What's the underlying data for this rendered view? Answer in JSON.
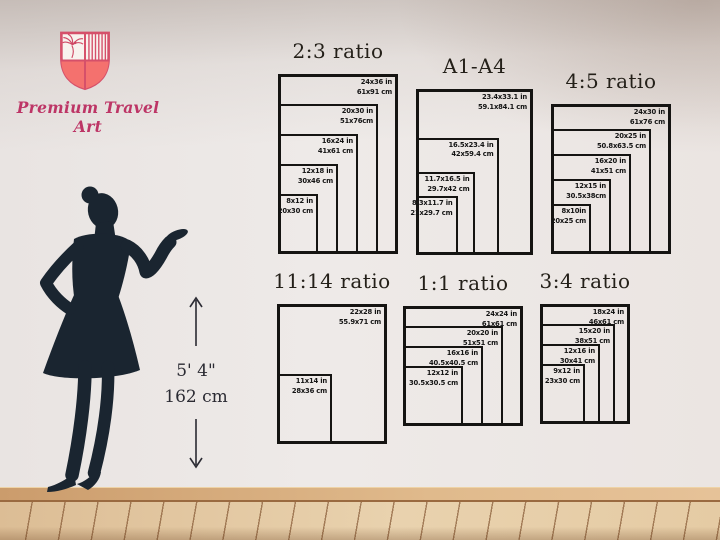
{
  "brand": {
    "name": "Premium Travel Art",
    "logo_icon": "shield-crest-icon",
    "accent_color": "#c9426b",
    "shield_fill_color": "#f4716e"
  },
  "height_marker": {
    "imperial": "5' 4\"",
    "metric": "162 cm"
  },
  "silhouette": {
    "description": "woman-silhouette",
    "color": "#1a2530"
  },
  "chart_data": [
    {
      "type": "nested-rectangles",
      "title": "2:3 ratio",
      "unit_scale_px_per_inch": 5,
      "position": {
        "left": 278,
        "top": 74
      },
      "sizes": [
        {
          "in": "24x36 in",
          "cm": "61x91 cm",
          "w": 24,
          "h": 36
        },
        {
          "in": "20x30 in",
          "cm": "51x76cm",
          "w": 20,
          "h": 30
        },
        {
          "in": "16x24 in",
          "cm": "41x61 cm",
          "w": 16,
          "h": 24
        },
        {
          "in": "12x18 in",
          "cm": "30x46 cm",
          "w": 12,
          "h": 18
        },
        {
          "in": "8x12 in",
          "cm": "20x30 cm",
          "w": 8,
          "h": 12
        }
      ]
    },
    {
      "type": "nested-rectangles",
      "title": "A1-A4",
      "unit_scale_px_per_inch": 5,
      "position": {
        "left": 416,
        "top": 89
      },
      "sizes": [
        {
          "in": "23.4x33.1 in",
          "cm": "59.1x84.1 cm",
          "w": 23.4,
          "h": 33.1
        },
        {
          "in": "16.5x23.4 in",
          "cm": "42x59.4 cm",
          "w": 16.5,
          "h": 23.4
        },
        {
          "in": "11.7x16.5 in",
          "cm": "29.7x42 cm",
          "w": 11.7,
          "h": 16.5
        },
        {
          "in": "8.3x11.7 in",
          "cm": "21x29.7 cm",
          "w": 8.3,
          "h": 11.7
        }
      ]
    },
    {
      "type": "nested-rectangles",
      "title": "4:5 ratio",
      "unit_scale_px_per_inch": 5,
      "position": {
        "left": 551,
        "top": 104
      },
      "sizes": [
        {
          "in": "24x30 in",
          "cm": "61x76 cm",
          "w": 24,
          "h": 30
        },
        {
          "in": "20x25 in",
          "cm": "50.8x63.5 cm",
          "w": 20,
          "h": 25
        },
        {
          "in": "16x20 in",
          "cm": "41x51 cm",
          "w": 16,
          "h": 20
        },
        {
          "in": "12x15 in",
          "cm": "30.5x38cm",
          "w": 12,
          "h": 15
        },
        {
          "in": "8x10in",
          "cm": "20x25 cm",
          "w": 8,
          "h": 10
        }
      ]
    },
    {
      "type": "nested-rectangles",
      "title": "11:14 ratio",
      "unit_scale_px_per_inch": 5,
      "position": {
        "left": 277,
        "top": 304
      },
      "sizes": [
        {
          "in": "22x28 in",
          "cm": "55.9x71 cm",
          "w": 22,
          "h": 28
        },
        {
          "in": "11x14 in",
          "cm": "28x36 cm",
          "w": 11,
          "h": 14
        }
      ]
    },
    {
      "type": "nested-rectangles",
      "title": "1:1 ratio",
      "unit_scale_px_per_inch": 5,
      "position": {
        "left": 403,
        "top": 306
      },
      "sizes": [
        {
          "in": "24x24 in",
          "cm": "61x61 cm",
          "w": 24,
          "h": 24
        },
        {
          "in": "20x20 in",
          "cm": "51x51 cm",
          "w": 20,
          "h": 20
        },
        {
          "in": "16x16 in",
          "cm": "40.5x40.5 cm",
          "w": 16,
          "h": 16
        },
        {
          "in": "12x12 in",
          "cm": "30.5x30.5 cm",
          "w": 12,
          "h": 12
        }
      ]
    },
    {
      "type": "nested-rectangles",
      "title": "3:4 ratio",
      "unit_scale_px_per_inch": 5,
      "position": {
        "left": 540,
        "top": 304
      },
      "sizes": [
        {
          "in": "18x24 in",
          "cm": "46x61 cm",
          "w": 18,
          "h": 24
        },
        {
          "in": "15x20 in",
          "cm": "38x51 cm",
          "w": 15,
          "h": 20
        },
        {
          "in": "12x16 in",
          "cm": "30x41 cm",
          "w": 12,
          "h": 16
        },
        {
          "in": "9x12 in",
          "cm": "23x30 cm",
          "w": 9,
          "h": 12
        }
      ]
    }
  ]
}
